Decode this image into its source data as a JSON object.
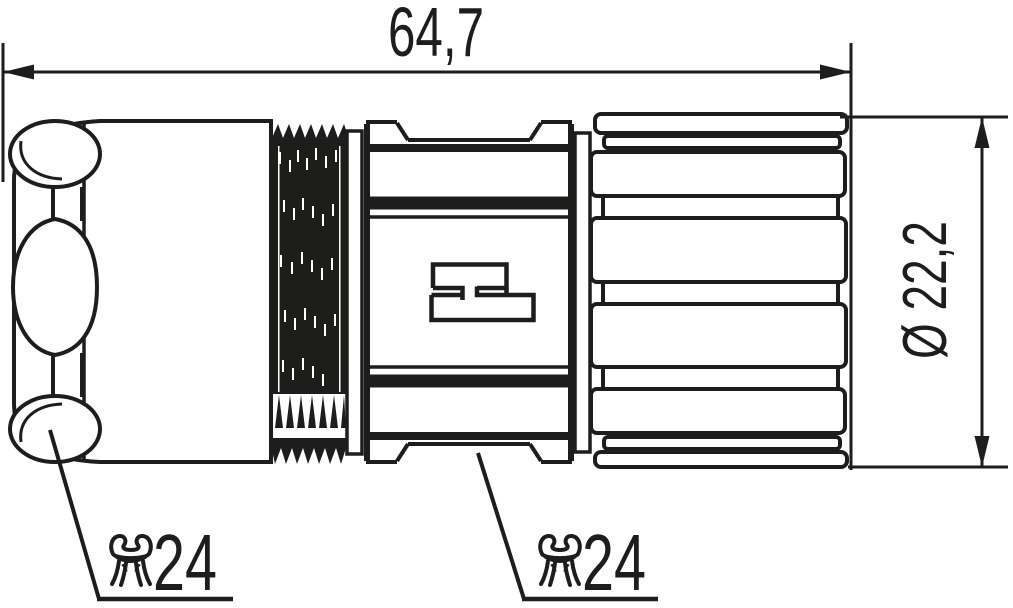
{
  "colors": {
    "line": "#1d1d1b",
    "background": "#ffffff"
  },
  "dimensions": {
    "overall_length": "64,7",
    "outer_diameter": "Ø 22,2"
  },
  "callouts": {
    "left": {
      "icon": "wrench-icon",
      "wrench_size": "24"
    },
    "right": {
      "icon": "wrench-icon",
      "wrench_size": "24"
    }
  }
}
